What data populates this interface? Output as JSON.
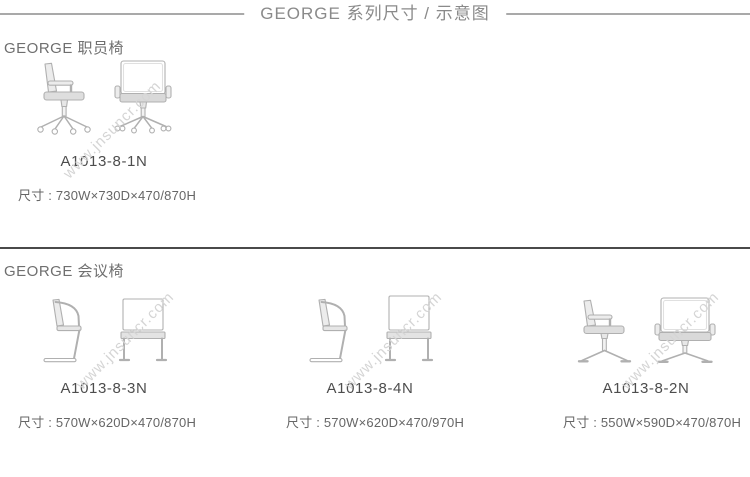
{
  "page": {
    "title": "GEORGE 系列尺寸 / 示意图",
    "watermark": "www.jnsuncr.com"
  },
  "sections": [
    {
      "heading": "GEORGE 职员椅",
      "products": [
        {
          "model": "A1013-8-1N",
          "dims": "尺寸 : 730W×730D×470/870H"
        }
      ]
    },
    {
      "heading": "GEORGE 会议椅",
      "products": [
        {
          "model": "A1013-8-3N",
          "dims": "尺寸 : 570W×620D×470/870H"
        },
        {
          "model": "A1013-8-4N",
          "dims": "尺寸 : 570W×620D×470/970H"
        },
        {
          "model": "A1013-8-2N",
          "dims": "尺寸 : 550W×590D×470/870H"
        }
      ]
    }
  ],
  "colors": {
    "title_text": "#8a8a8a",
    "rule_light": "#a9a9a9",
    "divider_dark": "#4a4a4a",
    "heading_text": "#6f6f6f",
    "model_text": "#4d4d4d",
    "dims_text": "#666666",
    "drawing_stroke": "#b0b0b0",
    "watermark_text": "#d5d5d5"
  }
}
